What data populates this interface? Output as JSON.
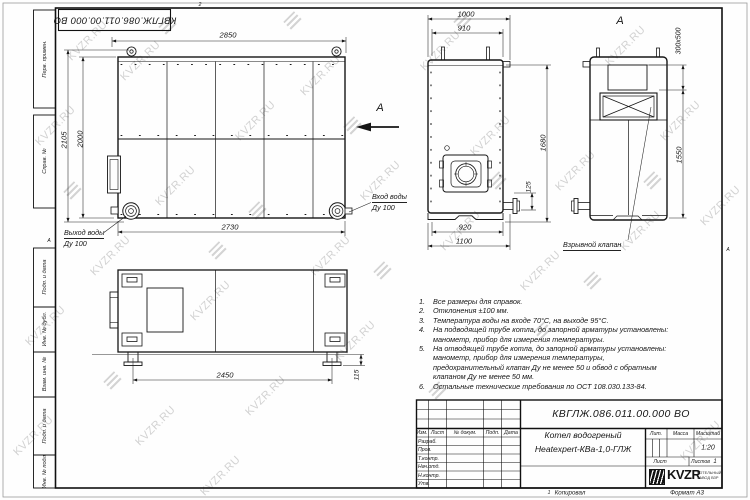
{
  "sheet": {
    "stamp_top": "КВГЛЖ.086.011.00.000 ВО",
    "watermark_text": "KVZR.RU",
    "zones": {
      "top": "2",
      "left": "А",
      "right": "А",
      "bottom": "1"
    },
    "frame_labels": {
      "perv": "Перв. примен.",
      "sprav": "Справ. №",
      "podp1": "Подп. и дата",
      "inv_dubl": "Инв. № дубл.",
      "vzam": "Взам. инв. №",
      "podp2": "Подп. и дата",
      "inv_podl": "Инв. № подл."
    }
  },
  "views": {
    "front": {
      "dim_width_top": "2850",
      "dim_height_outer": "2105",
      "dim_height_body": "2000",
      "dim_width_bottom": "2730",
      "outlet_line1": "Выход воды",
      "outlet_line2": "Ду 100",
      "inlet_line1": "Вход воды",
      "inlet_line2": "Ду 100",
      "section_arrow": "А"
    },
    "side": {
      "dim_width_top": "1000",
      "dim_width_shell": "910",
      "dim_height": "1680",
      "dim_flange_offset": "125",
      "dim_width_shell_bottom": "920",
      "dim_width_bottom": "1100"
    },
    "rear": {
      "view_label": "А",
      "dim_valve": "300х500",
      "dim_height": "1550",
      "callout_valve": "Взрывной клапан"
    },
    "bottom": {
      "dim_leg_span": "2450",
      "dim_leg_height": "115"
    }
  },
  "notes": {
    "items": [
      {
        "n": "1.",
        "t": "Все размеры для справок."
      },
      {
        "n": "2.",
        "t": "Отклонения ±100 мм."
      },
      {
        "n": "3.",
        "t": "Температура воды на входе 70°С, на выходе 95°С."
      },
      {
        "n": "4.",
        "t": "На подводящей трубе котла, до запорной арматуры установлены: манометр, прибор для измерения температуры."
      },
      {
        "n": "5.",
        "t": "На отводящей трубе котла, до запорной арматуры установлены: манометр, прибор для измерения температуры, предохранительный клапан Ду не менее 50 и обвод с обратным клапаном Ду не менее 50 мм."
      },
      {
        "n": "6.",
        "t": "Остальные технические требования по ОСТ 108.030.133-84."
      }
    ]
  },
  "title_block": {
    "doc_number": "КВГЛЖ.086.011.00.000 ВО",
    "product_name_line1": "Котел водогреный",
    "product_name_line2": "Heatexpert-КВа-1,0-ГЛЖ",
    "columns": {
      "izm": "Изм.",
      "list": "Лист",
      "doc": "№ докум.",
      "podp": "Подп.",
      "data": "Дата"
    },
    "rows": [
      "Разраб.",
      "Пров.",
      "Т.контр.",
      "Нач.отд.",
      "Н.контр.",
      "Утв."
    ],
    "lit_label": "Лит.",
    "mass_label": "Масса",
    "scale_label": "Масштаб",
    "scale_value": "1:20",
    "sheet_label": "Лист",
    "sheets_label": "Листов",
    "sheets_value": "1",
    "logo_text": "KVZR",
    "logo_sub_line1": "КОТЕЛЬНЫЙ",
    "logo_sub_line2": "ЗАВОД ВЗР",
    "copied_label": "Копировал",
    "format_label": "Формат А3"
  }
}
